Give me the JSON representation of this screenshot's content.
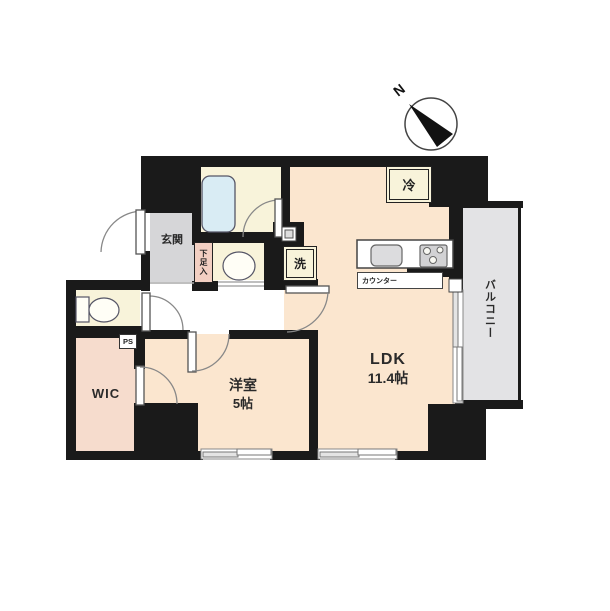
{
  "floorplan": {
    "compass": {
      "label": "N"
    },
    "labels": {
      "entrance": "玄関",
      "shoe_cabinet": "下足入",
      "washer": "洗",
      "refrigerator": "冷",
      "counter": "カウンター",
      "pipe_space": "PS",
      "wic": "WIC",
      "western_room_name": "洋室",
      "western_room_size": "5帖",
      "ldk_name": "LDK",
      "ldk_size": "11.4帖",
      "balcony": "バルコニー"
    },
    "colors": {
      "wall": "#1a1a1a",
      "room_peach": "#fbe6cf",
      "room_cream": "#f8f3da",
      "wic_pink": "#f6dccd",
      "shoe_pink": "#f2cfc2",
      "entrance_gray": "#d6d6d8",
      "balcony_gray": "#e3e3e5",
      "bathtub_blue": "#d9ecf4",
      "counter_white": "#ffffff"
    }
  }
}
